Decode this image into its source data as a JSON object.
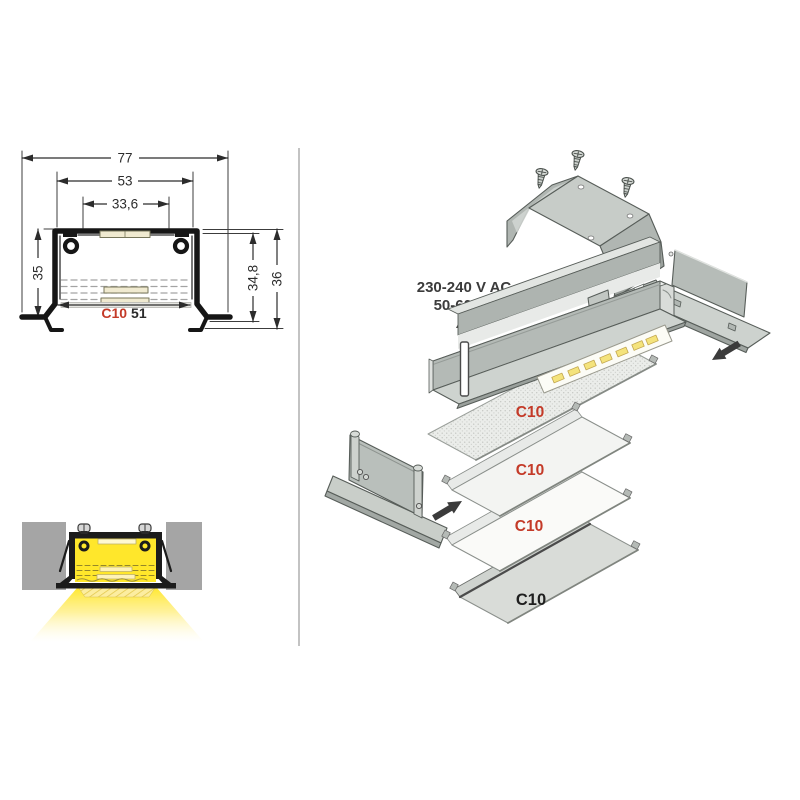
{
  "cross_section": {
    "overall_width": "77",
    "profile_width": "53",
    "inner_width": "33,6",
    "profile_height": "35",
    "recess_depth": "34,8",
    "total_height": "36",
    "cover_code": "C10",
    "cover_code_color": "#c43a28",
    "cover_width": "51"
  },
  "exploded_view": {
    "power_rating_line1": "230-240 V AC",
    "power_rating_line2": "50-60 Hz",
    "cover_labels": [
      {
        "text": "C10",
        "color": "#c43a28"
      },
      {
        "text": "C10",
        "color": "#c43a28"
      },
      {
        "text": "C10",
        "color": "#c43a28"
      },
      {
        "text": "C10",
        "color": "#1f1f1f"
      }
    ]
  },
  "colors": {
    "accent_red": "#c43a28",
    "line_black": "#1b1b1b",
    "metal_gray": "#b8bdb9",
    "light_yellow": "#ffe72b",
    "divider_gray": "#9b9b9b"
  }
}
